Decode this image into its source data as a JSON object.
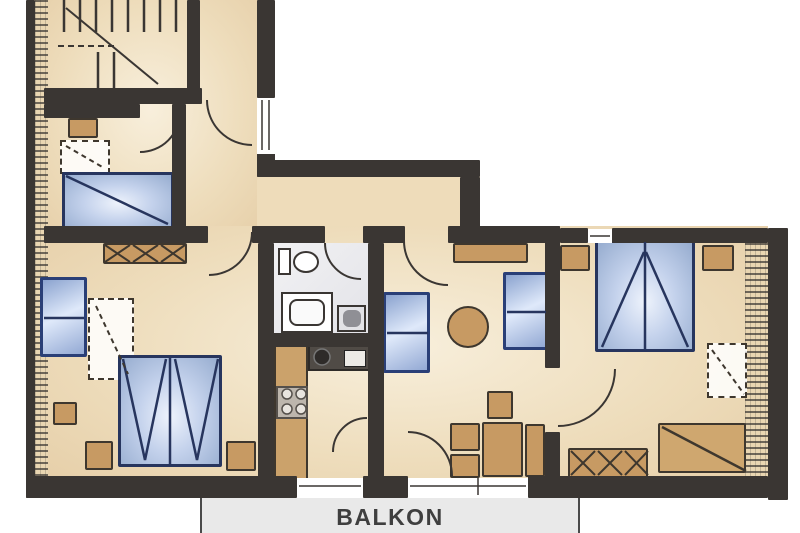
{
  "balcony": {
    "label": "BALKON"
  },
  "colors": {
    "wall": "#3a3633",
    "floor": "#eeddbc",
    "bathroom_floor": "#ececef",
    "furniture_brown": "#c79a63",
    "furniture_blue_fill": "#c4d2ec",
    "furniture_blue_border": "#27355e",
    "balcony_bg": "#e9e9e9",
    "balcony_text": "#3f3f3f"
  }
}
